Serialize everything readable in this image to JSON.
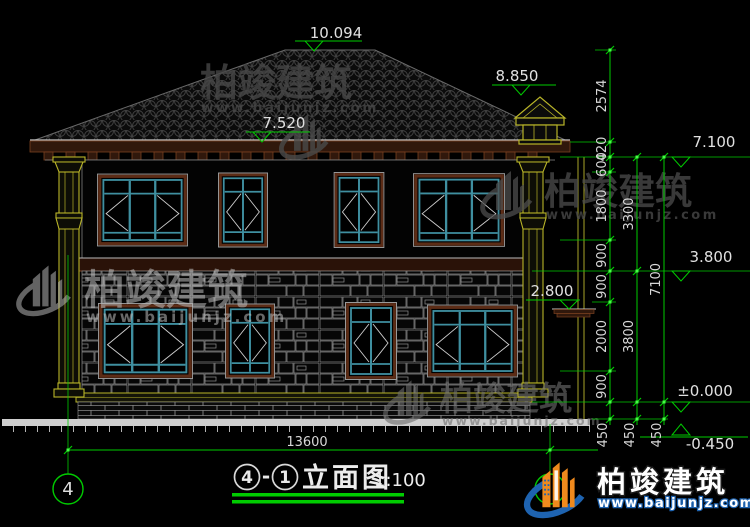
{
  "brand": {
    "name": "柏竣建筑",
    "url": "www.baijunjz.com"
  },
  "elevations": {
    "ridge": "10.094",
    "chimney": "8.850",
    "eave": "7.520",
    "upper": "7.100",
    "mid": "3.800",
    "canopy": "2.800",
    "zero": "±0.000",
    "ground": "-0.450"
  },
  "dims": {
    "chain_a": [
      "2574",
      "420",
      "600",
      "1800",
      "900",
      "900",
      "2000",
      "900",
      "450"
    ],
    "chain_b": [
      "3300",
      "3800",
      "450"
    ],
    "chain_c": [
      "7100",
      "450"
    ],
    "total_width": "13600"
  },
  "axes": {
    "left": "4"
  },
  "title": {
    "bubble_start": "4",
    "separator": "-",
    "bubble_end": "1",
    "name": "立面图",
    "scale": "1:100"
  }
}
